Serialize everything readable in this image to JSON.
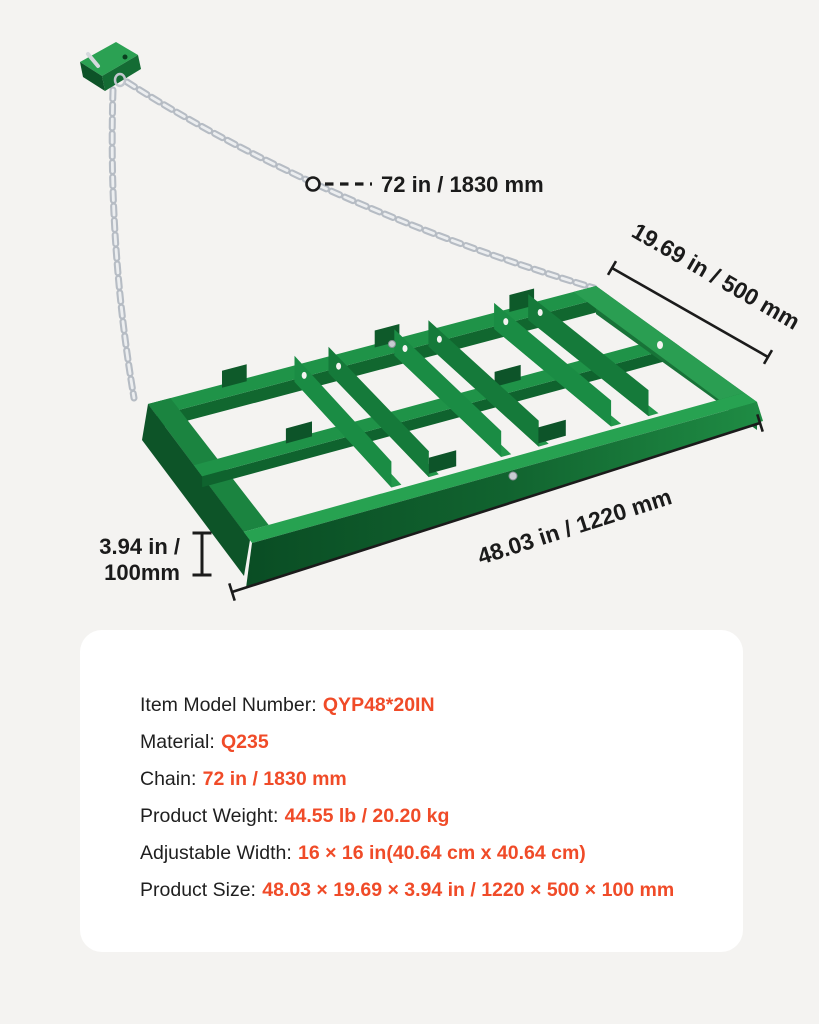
{
  "colors": {
    "background": "#f4f3f1",
    "panel": "#ffffff",
    "accent_orange": "#f04b28",
    "annotation_ink": "#1b1b1b",
    "frame_green": "#219349",
    "frame_green_dark": "#0d5429",
    "frame_green_light": "#2fa75a",
    "chain_silver": "#b6bcc4"
  },
  "annotations": {
    "chain_length": "72 in / 1830 mm",
    "depth": "19.69 in / 500 mm",
    "width": "48.03 in / 1220 mm",
    "height_line1": "3.94 in /",
    "height_line2": "100mm"
  },
  "specs": {
    "rows": [
      {
        "label": "Item Model Number:",
        "value": "QYP48*20IN"
      },
      {
        "label": "Material:",
        "value": "Q235"
      },
      {
        "label": "Chain:",
        "value": "72 in / 1830 mm"
      },
      {
        "label": "Product Weight:",
        "value": "44.55 lb / 20.20 kg"
      },
      {
        "label": "Adjustable Width:",
        "value": "16 × 16 in(40.64 cm x 40.64 cm)"
      },
      {
        "label": "Product Size:",
        "value": "48.03 × 19.69 × 3.94 in / 1220 × 500 × 100 mm"
      }
    ]
  }
}
